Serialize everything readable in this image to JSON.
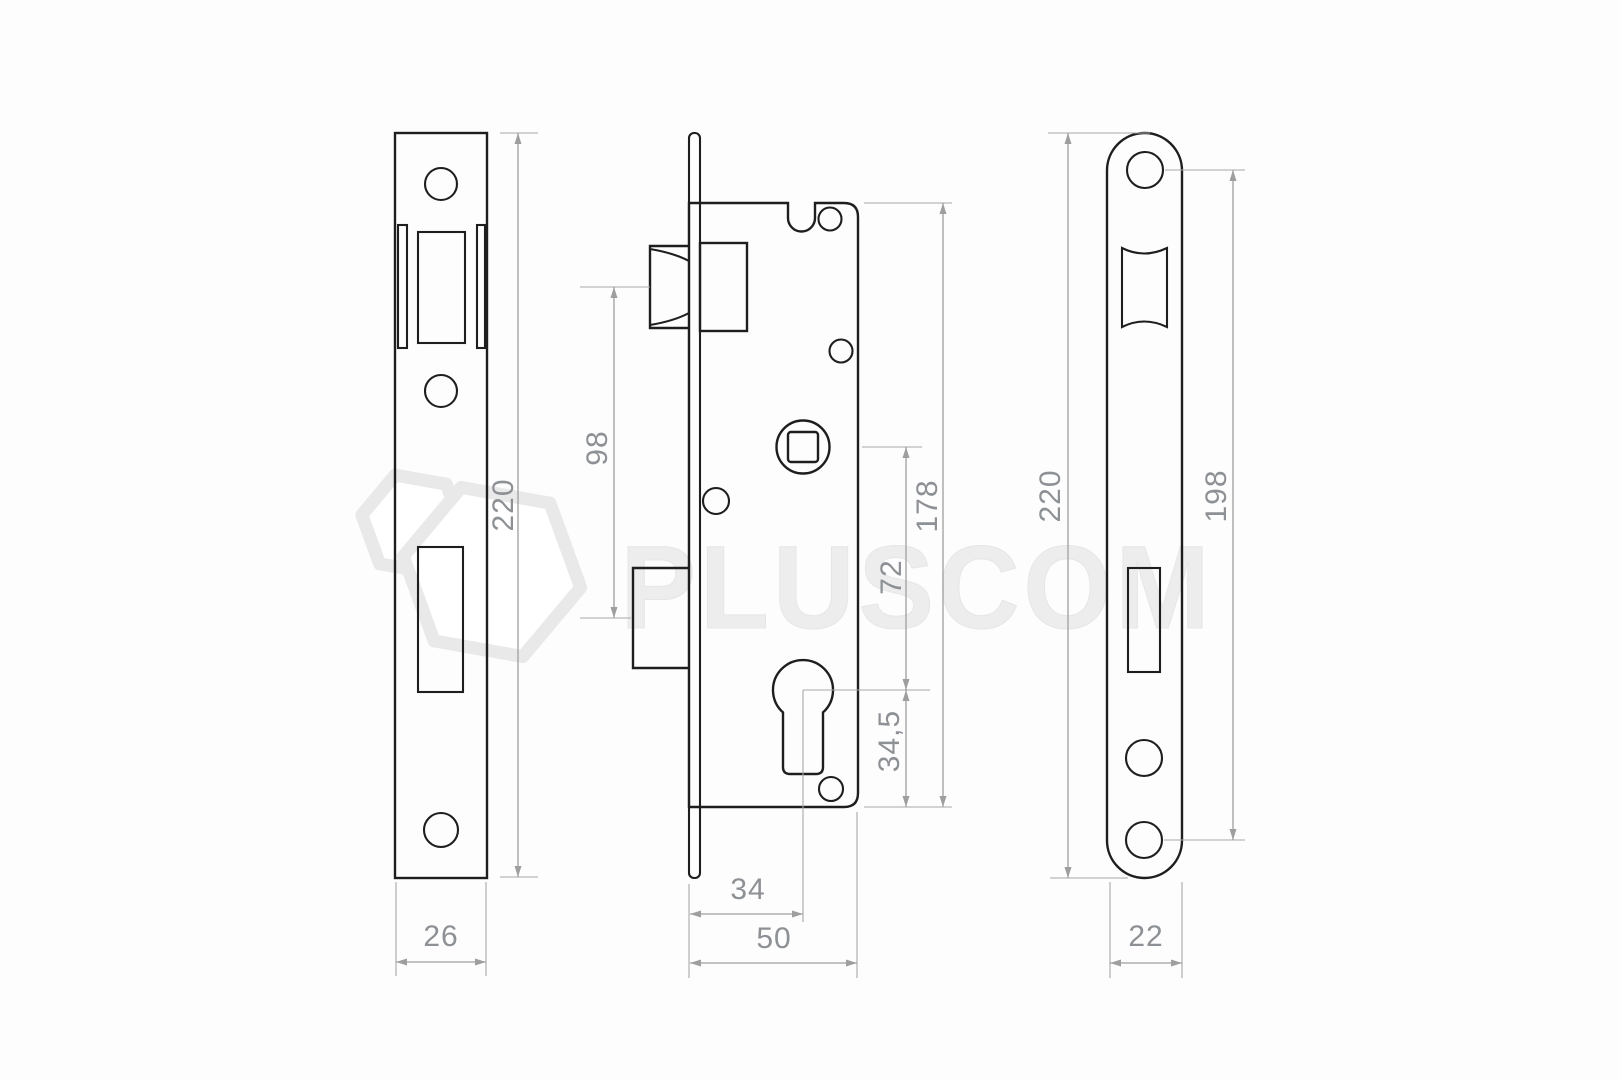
{
  "watermark": {
    "brand": "PLUSCOM",
    "logo": "hexagon-cube-logo"
  },
  "colors": {
    "background": "#fdfdfd",
    "part_outline": "#1e1e1e",
    "dimension_line": "#9e9e9e",
    "dimension_text": "#8d9094",
    "watermark": "#ededed"
  },
  "views": {
    "strike_plate": {
      "name": "strike plate front view",
      "dims": {
        "height": "220",
        "width": "26"
      }
    },
    "lock_body": {
      "name": "lock body side view",
      "dims": {
        "latch_to_deadbolt": "98",
        "case_height": "178",
        "spindle_to_cylinder": "72",
        "cylinder_to_bottom": "34,5",
        "backset": "34",
        "case_depth": "50"
      }
    },
    "faceplate": {
      "name": "faceplate front view",
      "dims": {
        "height": "220",
        "hole_spacing": "198",
        "width": "22"
      }
    }
  }
}
